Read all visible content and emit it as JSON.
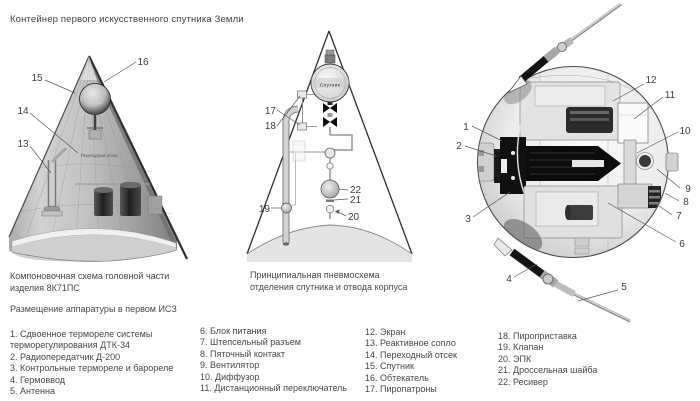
{
  "title": "Контейнер первого искусственного спутника Земли",
  "captions": {
    "left1": "Компоновочная схема головной части",
    "left2": "изделия 8К71ПС",
    "mid1": "Принципиальная пневмосхема",
    "mid2": "отделения спутника и отвода корпуса",
    "legend_header": "Размещение аппаратуры в первом ИСЗ"
  },
  "legend": {
    "col1": [
      "1. Сдвоенное термореле системы",
      "терморегулирования ДТК-34",
      "2. Радиопередатчик Д-200",
      "3. Контрольные термореле и барореле",
      "4. Гермоввод",
      "5. Антенна"
    ],
    "col2": [
      "6. Блок питания",
      "7. Штепсельный разъем",
      "8. Пяточный контакт",
      "9. Вентилятор",
      "10. Диффузор",
      "11. Дистанционный переключатель"
    ],
    "col3": [
      "12. Экран",
      "13. Реактивное сопло",
      "14. Переходный отсек",
      "15. Спутник",
      "16. Обтекатель",
      "17. Пиропатроны"
    ],
    "col4": [
      "18. Пироприставка",
      "19. Клапан",
      "20. ЭПК",
      "21. Дроссельная шайба",
      "22. Ресивер"
    ]
  },
  "callouts": {
    "n1": "1",
    "n2": "2",
    "n3": "3",
    "n4": "4",
    "n5": "5",
    "n6": "6",
    "n7": "7",
    "n8": "8",
    "n9": "9",
    "n10": "10",
    "n11": "11",
    "n12": "12",
    "n13": "13",
    "n14": "14",
    "n15": "15",
    "n16": "16",
    "n17": "17",
    "n18": "18",
    "n19": "19",
    "n20": "20",
    "n21": "21",
    "n22": "22"
  },
  "diagram_texts": {
    "sputnik_left": "Спутник",
    "sputnik_mid": "Спутник",
    "transition": "Переходный отсек"
  },
  "colors": {
    "ink": "#454545",
    "line": "#2e2e2e",
    "shade": "#9a9a9a"
  }
}
